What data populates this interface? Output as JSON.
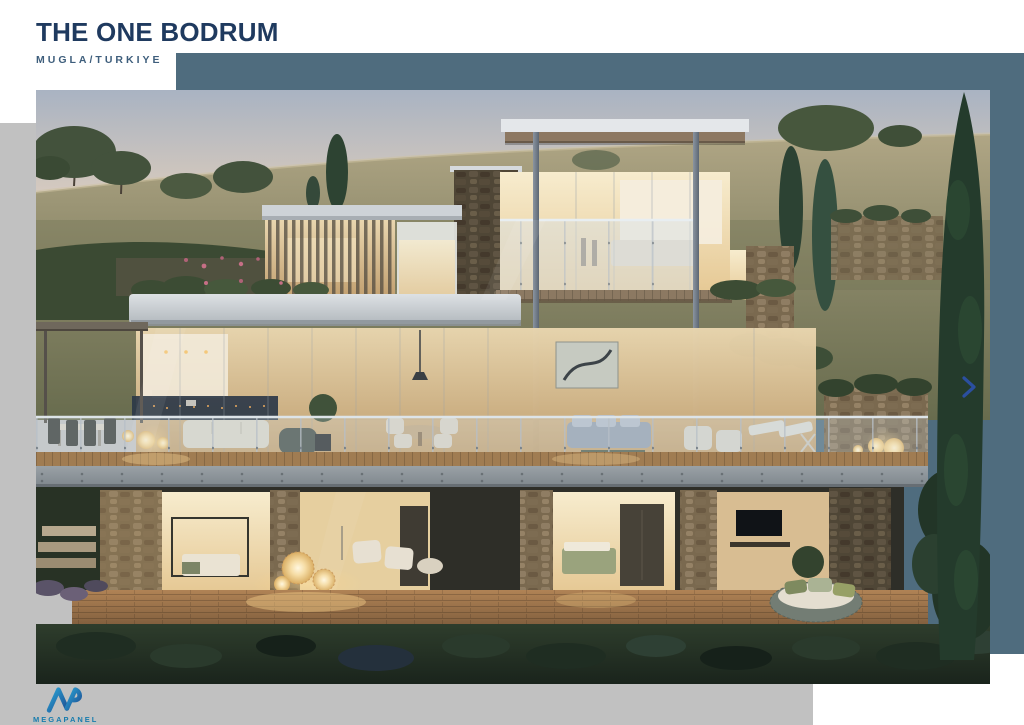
{
  "slide": {
    "title": "THE ONE BODRUM",
    "subtitle": "MUGLA/TURKIYE",
    "photo_alt": "Dusk architectural rendering of a three-level modern hillside villa: glass facades with warm lit interiors, stone pillars, wooden decks, glass-railed terraces with lounge furniture, glowing sphere lanterns, cypress trees and Mediterranean shrubland",
    "accent_color": "#4F6C7E",
    "panel_gray": "#C1C1C1",
    "title_color": "#1F3A5F",
    "subtitle_color": "#3E5E7C"
  },
  "nav": {
    "next_arrow_color": "#2B4FA0"
  },
  "logo": {
    "name": "MEGAPANEL",
    "accent": "#1B87B5"
  }
}
